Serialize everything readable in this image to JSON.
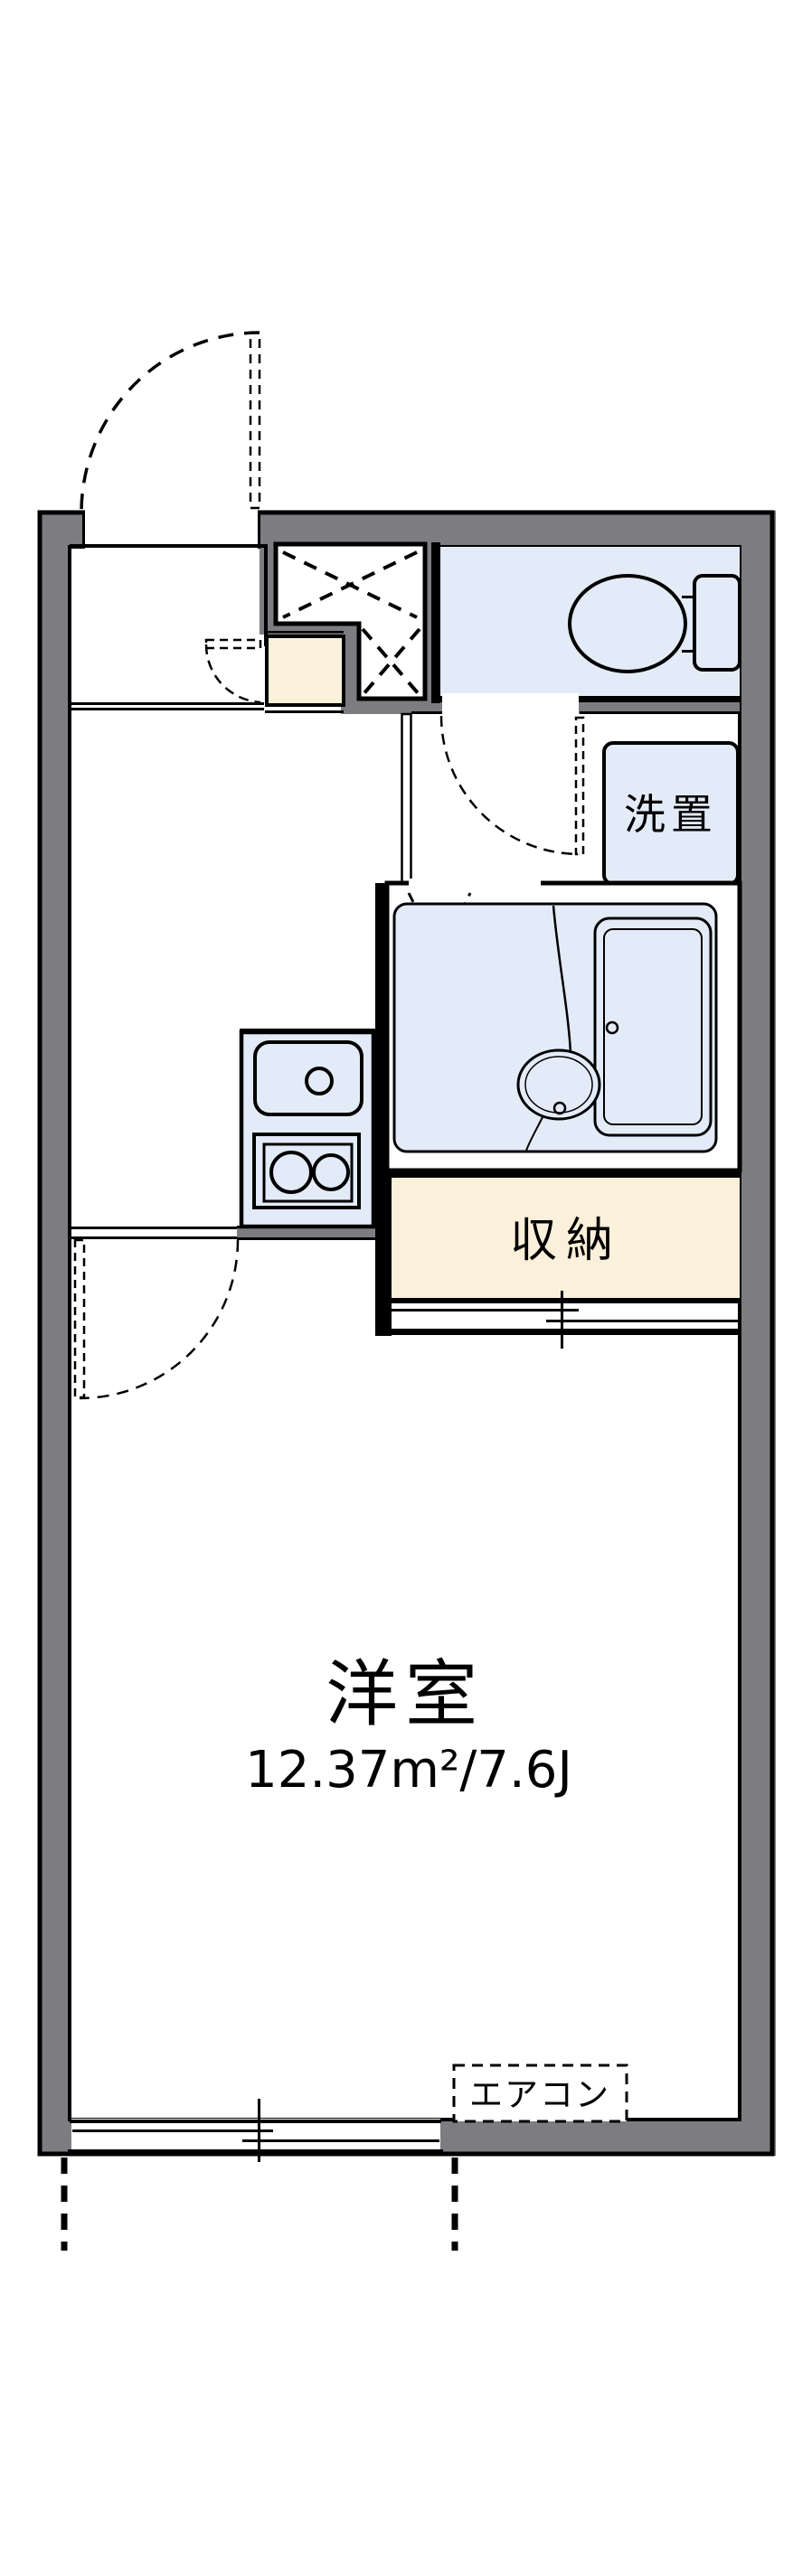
{
  "document": {
    "type": "apartment-floor-plan"
  },
  "colors": {
    "wall": "#7d7d81",
    "blue": "#e3ebf8",
    "cream": "#fbf0da",
    "ink": "#000000",
    "bg": "#ffffff"
  },
  "labels": {
    "main_room": "洋室",
    "main_room_size": "12.37m²/7.6J",
    "storage": "収納",
    "laundry": "洗置",
    "aircon": "エアコン"
  }
}
